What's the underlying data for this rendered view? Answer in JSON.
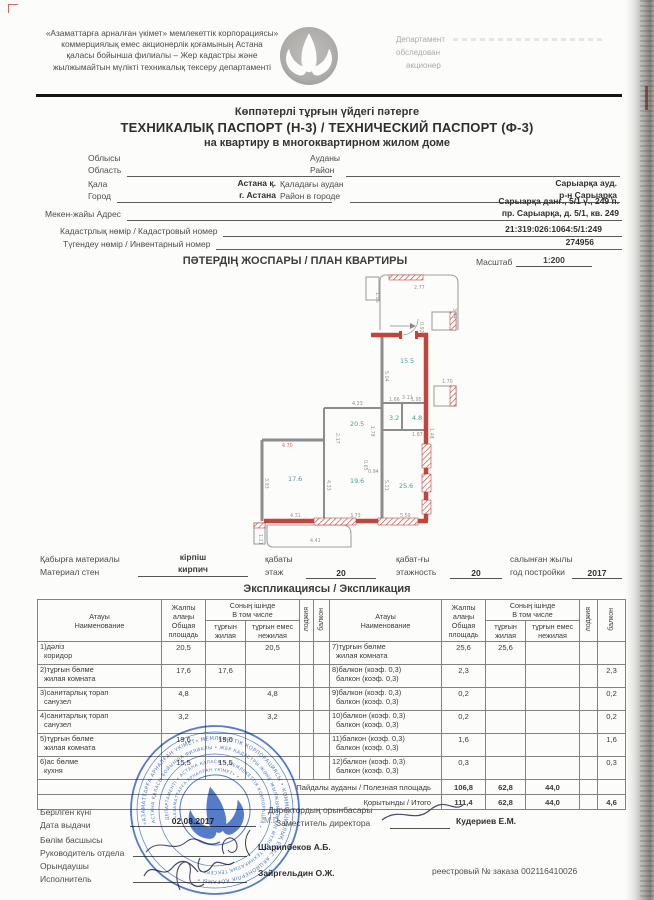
{
  "header": {
    "org_lines": [
      "«Азаматтарға арналған үкімет» мемлекеттік корпорациясы»",
      "коммерциялық емес акционерлік қоғамының Астана",
      "қаласы бойынша филиалы – Жер кадастры және",
      "жылжымайтын мүлікті техникалық тексеру департаменті"
    ],
    "dept_lines": [
      "Департамент",
      "обследован",
      "акционер"
    ]
  },
  "title": {
    "line1": "Көппәтерлі тұрғын үйдегі пәтерге",
    "line2": "ТЕХНИКАЛЫҚ ПАСПОРТ (Н-3) / ТЕХНИЧЕСКИЙ ПАСПОРТ (Ф-3)",
    "line3": "на квартиру в многоквартирном жилом доме"
  },
  "fields": {
    "oblast": {
      "label_kk": "Облысы",
      "label_ru": "Область",
      "value_kk": "",
      "value_ru": ""
    },
    "raion": {
      "label_kk": "Ауданы",
      "label_ru": "Район",
      "value_kk": "",
      "value_ru": ""
    },
    "city": {
      "label_kk": "Қала",
      "label_ru": "Город",
      "value_kk": "Астана қ.",
      "value_ru": "г. Астана"
    },
    "city_raion": {
      "label_kk": "Қаладағы аудан",
      "label_ru": "Район в городе",
      "value_kk": "Сарыарқа ауд.",
      "value_ru": "р-н Сарыарқа"
    },
    "address": {
      "label": "Мекен-жайы Адрес",
      "value_kk": "Сарыарқа данғ., 5/1 ү., 249 п.",
      "value_ru": "пр. Сарыарқа, д. 5/1, кв. 249"
    },
    "cadastre": {
      "label": "Кадастрлық нөмір / Кадастровый номер",
      "value": "21:319:026:1064:5/1:249"
    },
    "inventory": {
      "label": "Түгендеу нөмір / Инвентарный номер",
      "value": "274956"
    }
  },
  "plan": {
    "title": "ПӘТЕРДІҢ ЖОСПАРЫ / ПЛАН КВАРТИРЫ",
    "scale_label": "Масштаб",
    "scale_value": "1:200",
    "rooms": [
      {
        "v": "15.5",
        "x": 148,
        "y": 95
      },
      {
        "v": "3.2",
        "x": 137,
        "y": 152
      },
      {
        "v": "4.8",
        "x": 160,
        "y": 152
      },
      {
        "v": "20.5",
        "x": 98,
        "y": 158
      },
      {
        "v": "19.6",
        "x": 98,
        "y": 215
      },
      {
        "v": "17.6",
        "x": 36,
        "y": 213
      },
      {
        "v": "25.6",
        "x": 147,
        "y": 220
      }
    ],
    "dims": [
      {
        "v": "2.77",
        "x": 162,
        "y": 21
      },
      {
        "v": "1.26",
        "x": 124,
        "y": 24,
        "r": 90
      },
      {
        "v": "3.44",
        "x": 201,
        "y": 40,
        "r": 90
      },
      {
        "v": "0.92",
        "x": 168,
        "y": 54,
        "r": 90
      },
      {
        "v": "1.70",
        "x": 190,
        "y": 115
      },
      {
        "v": "5.04",
        "x": 133,
        "y": 103,
        "r": 90
      },
      {
        "v": "3.11",
        "x": 150,
        "y": 131
      },
      {
        "v": "4.23",
        "x": 100,
        "y": 137
      },
      {
        "v": "2.17",
        "x": 84,
        "y": 165,
        "r": 90
      },
      {
        "v": "1.66",
        "x": 137,
        "y": 133
      },
      {
        "v": "1.95",
        "x": 159,
        "y": 133
      },
      {
        "v": "1.48",
        "x": 178,
        "y": 160,
        "r": 90
      },
      {
        "v": "1.78",
        "x": 119,
        "y": 158,
        "r": 90
      },
      {
        "v": "0.65",
        "x": 112,
        "y": 192,
        "r": 90
      },
      {
        "v": "0.94",
        "x": 116,
        "y": 205
      },
      {
        "v": "4.33",
        "x": 75,
        "y": 212,
        "r": 90
      },
      {
        "v": "5.21",
        "x": 133,
        "y": 212,
        "r": 90
      },
      {
        "v": "3.93",
        "x": 13,
        "y": 210,
        "r": 90
      },
      {
        "v": "4.31",
        "x": 38,
        "y": 249
      },
      {
        "v": "3.73",
        "x": 98,
        "y": 249
      },
      {
        "v": "5.59",
        "x": 148,
        "y": 249
      },
      {
        "v": "4.41",
        "x": 58,
        "y": 274
      },
      {
        "v": "1.21",
        "x": 7,
        "y": 266,
        "r": 90
      },
      {
        "v": "1.87",
        "x": 160,
        "y": 168
      },
      {
        "v": "4.70",
        "x": 30,
        "y": 179,
        "red": true
      }
    ]
  },
  "materials": {
    "wall_label_kk": "Қабырға материалы",
    "wall_label_ru": "Материал стен",
    "wall_value_kk": "кірпіш",
    "wall_value_ru": "кирпич",
    "floor_label_kk": "қабаты",
    "floor_label_ru": "этаж",
    "floor_value": "20",
    "storeys_label_kk": "қабат-ғы",
    "storeys_label_ru": "этажность",
    "storeys_value": "20",
    "year_label_kk": "салынған жылы",
    "year_label_ru": "год постройки",
    "year_value": "2017"
  },
  "explication": {
    "section_title": "Экспликациясы / Экспликация",
    "headers": {
      "name_kk": "Атауы",
      "name_ru": "Наименование",
      "total_kk": "Жалпы алаңы",
      "total_ru": "Общая площадь",
      "incl_kk": "Соның ішінде",
      "incl_ru": "В том числе",
      "liv_kk": "тұрғын",
      "liv_ru": "жилая",
      "non_kk": "тұрғын емес",
      "non_ru": "нежилая",
      "loggia": "лоджия",
      "balcony": "балкон"
    },
    "rows": [
      {
        "l_kk": "1)дәліз",
        "l_ru": "коридор",
        "l_total": "20,5",
        "l_liv": "",
        "l_non": "20,5",
        "l_lodg": "",
        "l_balc": "",
        "r_kk": "7)тұрғын бөлме",
        "r_ru": "жилая комната",
        "r_total": "25,6",
        "r_liv": "25,6",
        "r_non": "",
        "r_lodg": "",
        "r_balc": ""
      },
      {
        "l_kk": "2)тұрғын бөлме",
        "l_ru": "жилая комната",
        "l_total": "17,6",
        "l_liv": "17,6",
        "l_non": "",
        "l_lodg": "",
        "l_balc": "",
        "r_kk": "8)балкон (коэф. 0,3)",
        "r_ru": "балкон (коэф. 0,3)",
        "r_total": "2,3",
        "r_liv": "",
        "r_non": "",
        "r_lodg": "",
        "r_balc": "2,3"
      },
      {
        "l_kk": "3)санитарлық торап",
        "l_ru": "санузел",
        "l_total": "4,8",
        "l_liv": "",
        "l_non": "4,8",
        "l_lodg": "",
        "l_balc": "",
        "r_kk": "9)балкон (коэф. 0,3)",
        "r_ru": "балкон (коэф. 0,3)",
        "r_total": "0,2",
        "r_liv": "",
        "r_non": "",
        "r_lodg": "",
        "r_balc": "0,2"
      },
      {
        "l_kk": "4)санитарлық торап",
        "l_ru": "санузел",
        "l_total": "3,2",
        "l_liv": "",
        "l_non": "3,2",
        "l_lodg": "",
        "l_balc": "",
        "r_kk": "10)балкон (коэф. 0,3)",
        "r_ru": "балкон (коэф. 0,3)",
        "r_total": "0,2",
        "r_liv": "",
        "r_non": "",
        "r_lodg": "",
        "r_balc": "0,2"
      },
      {
        "l_kk": "5)тұрғын бөлме",
        "l_ru": "жилая комната",
        "l_total": "19,6",
        "l_liv": "19,6",
        "l_non": "",
        "l_lodg": "",
        "l_balc": "",
        "r_kk": "11)балкон (коэф. 0,3)",
        "r_ru": "балкон (коэф. 0,3)",
        "r_total": "1,6",
        "r_liv": "",
        "r_non": "",
        "r_lodg": "",
        "r_balc": "1,6"
      },
      {
        "l_kk": "6)ас бөлме",
        "l_ru": "кухня",
        "l_total": "15,5",
        "l_liv": "15,5",
        "l_non": "",
        "l_lodg": "",
        "l_balc": "",
        "r_kk": "12)балкон (коэф. 0,3)",
        "r_ru": "балкон (коэф. 0,3)",
        "r_total": "0,3",
        "r_liv": "",
        "r_non": "",
        "r_lodg": "",
        "r_balc": "0,3"
      }
    ],
    "summary": [
      {
        "label": "Пайдалы ауданы / Полезная площадь",
        "total": "106,8",
        "liv": "62,8",
        "non": "44,0",
        "lodg": "",
        "balc": ""
      },
      {
        "label": "Қорытынды / Итого",
        "total": "111,4",
        "liv": "62,8",
        "non": "44,0",
        "lodg": "",
        "balc": "4,6"
      }
    ]
  },
  "signatures": {
    "date_label_kk": "Берілген күні",
    "date_label_ru": "Дата выдачи",
    "date_value": "02.08.2017",
    "mp": "М.П",
    "deputy_label_kk": "Директордың орынбасары",
    "deputy_label_ru": "Заместитель директора",
    "deputy_name": "Кудериев Е.М.",
    "head_label_kk": "Бөлім басшысы",
    "head_label_ru": "Руководитель отдела",
    "head_name": "Шарипбеков А.Б.",
    "executor_label_kk": "Орындаушы",
    "executor_label_ru": "Исполнитель",
    "executor_name": "Зайргельдин О.Ж.",
    "registry": "реестровый № заказа 002116410026"
  },
  "stamp": {
    "ring_outer": "«АЗАМАТТАРҒА АРНАЛҒАН ҮКІМЕТ» МЕМЛЕКЕТТІК КОРПОРАЦИЯСЫ • КОММЕРЦИЯЛЫҚ ЕМЕС АКЦИОНЕРЛІК ҚОҒАМЫ • ",
    "ring_mid": "АСТАНА ҚАЛАСЫ БОЙЫНША ФИЛИАЛЫ • ЖЕР КАДАСТРЫ ЖӘНЕ ЖЫЛЖЫМАЙТЫН МҮЛІКТІ ТЕХНИКАЛЫҚ ТЕКСЕРУ • ",
    "ring_inner": "ДЕПАРТАМЕНТІ • АСТАНА ҚАЛАСЫ • МЕМЛЕКЕТТІК КОРПОРАЦИЯ • ",
    "ring_core": "«АЗАМАТТАРҒА АРНАЛҒАН ҮКІМЕТ» • "
  },
  "colors": {
    "wall_red": "#c0453c",
    "room_teal": "#4d9b90",
    "stamp_blue": "#3d6bc7"
  }
}
